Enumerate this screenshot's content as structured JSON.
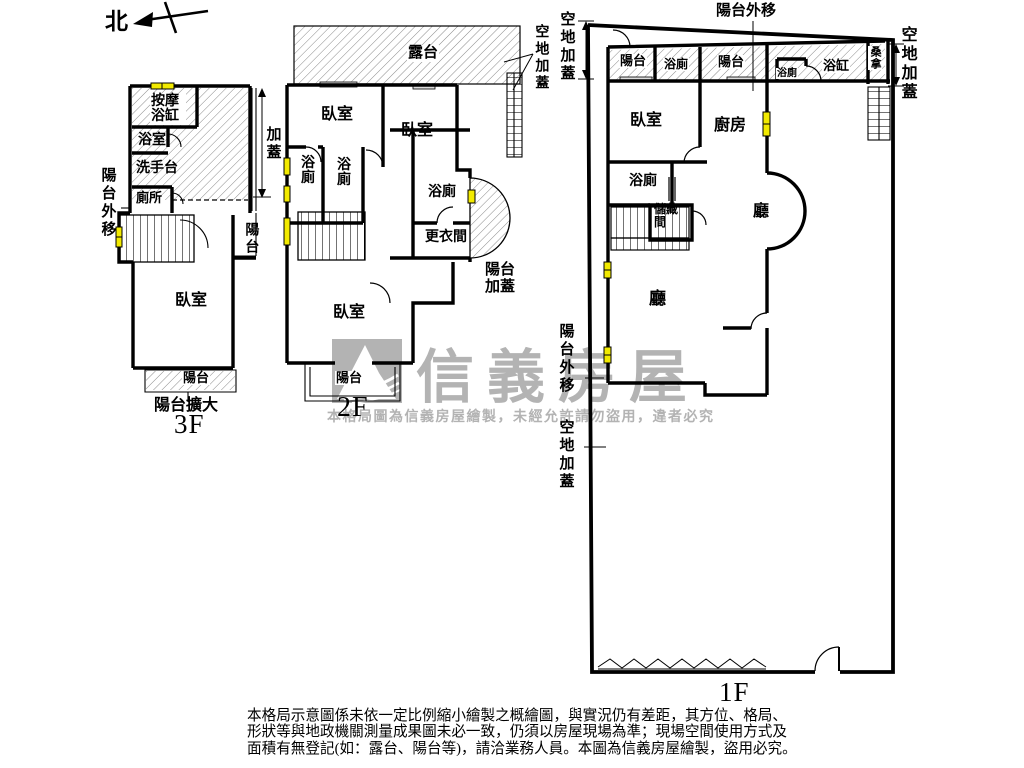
{
  "north_label": "北",
  "floor_3f": {
    "massage_tub": "按摩浴缸",
    "bathroom": "浴室",
    "washbasin": "洗手台",
    "toilet": "廁所",
    "balcony_out": "陽台外移",
    "add_cover": "加蓋",
    "balcony_right": "陽台",
    "bedroom": "臥室",
    "balcony_bottom": "陽台",
    "balcony_expanded": "陽台擴大",
    "floor_label": "3F"
  },
  "floor_2f": {
    "roof_terrace": "露台",
    "bedroom1": "臥室",
    "bedroom2": "臥室",
    "bath1": "浴廁",
    "bath2": "浴廁",
    "bath3": "浴廁",
    "dressing_room": "更衣間",
    "balcony_cover": "陽台加蓋",
    "bedroom3": "臥室",
    "balcony_bottom": "陽台",
    "open_land_cover": "空地加蓋",
    "floor_label": "2F"
  },
  "floor_1f": {
    "open_land_cover_top_left": "空地加蓋",
    "balcony_out_top": "陽台外移",
    "open_land_cover_right": "空地加蓋",
    "balcony_a": "陽台",
    "bath_a": "浴廁",
    "balcony_b": "陽台",
    "bath_b": "浴廁",
    "bathtub": "浴缸",
    "sauna": "桑拿",
    "bedroom": "臥室",
    "kitchen": "廚房",
    "bath_c": "浴廁",
    "storage": "儲藏間",
    "hall_upper": "廳",
    "hall_lower": "廳",
    "balcony_out_left": "陽台外移",
    "open_land_cover_bottom_left": "空地加蓋",
    "floor_label": "1F"
  },
  "watermark": {
    "brand": "信義房屋",
    "notice": "本格局圖為信義房屋繪製，未經允許請勿盜用，違者必究"
  },
  "disclaimer": {
    "line1": "本格局示意圖係未依一定比例縮小繪製之概繪圖，與實況仍有差距，其方位、格局、",
    "line2": "形狀等與地政機關測量成果圖未必一致，仍須以房屋現場為準；現場空間使用方式及",
    "line3": "面積有無登記(如：露台、陽台等)，請洽業務人員。本圖為信義房屋繪製，盜用必究。"
  },
  "colors": {
    "wall": "#000000",
    "window_marker": "#f2ea00",
    "watermark_gray": "#b3b3b3"
  }
}
